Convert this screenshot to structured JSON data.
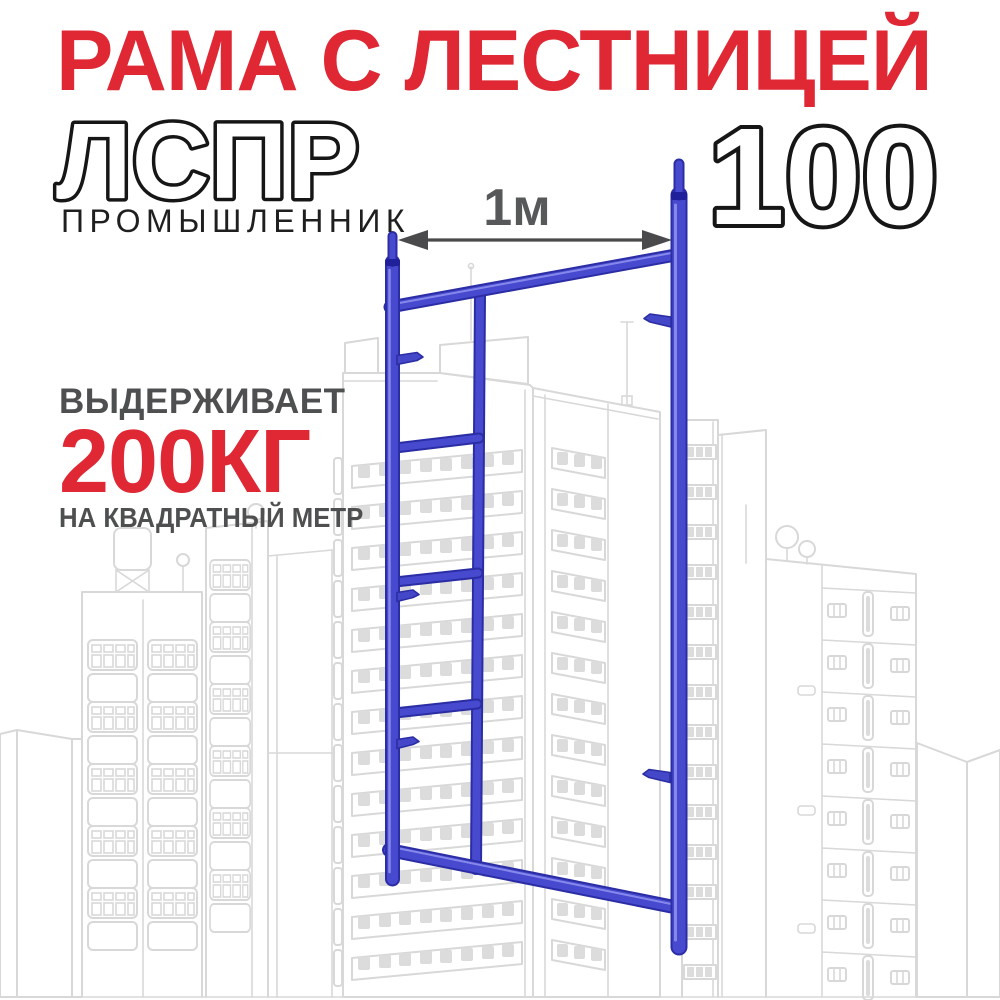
{
  "banner": {
    "title": "РАМА С ЛЕСТНИЦЕЙ",
    "model_code": "ЛСПР",
    "brand": "ПРОМЫШЛЕННИК",
    "size_label": "100",
    "dimension_label": "1м",
    "capacity": {
      "intro": "ВЫДЕРЖИВАЕТ",
      "value": "200КГ",
      "per": "НА КВАДРАТНЫЙ МЕТР"
    }
  },
  "illustration": {
    "subject": "scaffold-frame-with-ladder",
    "background": "city-buildings-outline-sketch",
    "icons": {
      "dimension_arrow": "double-headed-arrow"
    }
  },
  "colors": {
    "accent_red": "#e02734",
    "frame_blue": "#4749cf",
    "outline_text_stroke": "#161616",
    "muted_gray": "#4e4f51",
    "building_line_gray": "#d8d8d8"
  }
}
